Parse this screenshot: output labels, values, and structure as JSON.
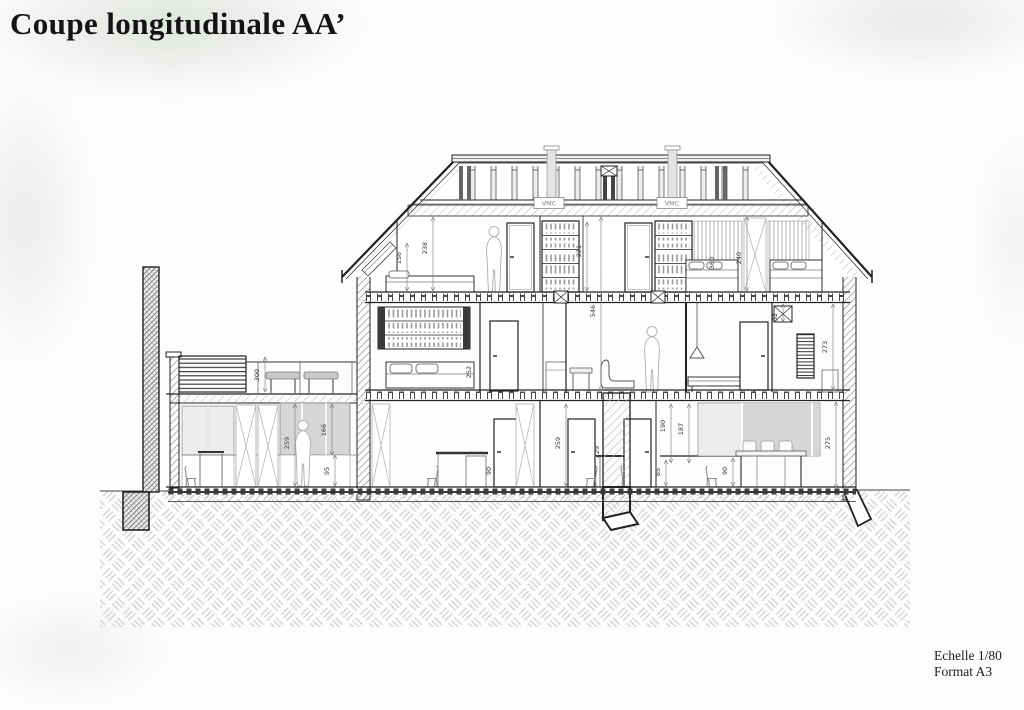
{
  "title": "Coupe longitudinale AA’",
  "footer": {
    "scale": "Echelle 1/80",
    "format": "Format A3"
  },
  "colors": {
    "ink": "#222222",
    "wall_hatch": "#8a8a8a",
    "ground_hatch": "#d2d2d2",
    "glazing_light": "#ececec",
    "glazing_dark": "#d6d6d6"
  },
  "drawing": {
    "vmc_labels": [
      {
        "text": "VMC",
        "x": 549,
        "y": 203
      },
      {
        "text": "VMC",
        "x": 672,
        "y": 203
      }
    ],
    "dimension_labels": [
      {
        "text": "156",
        "x": 401,
        "y": 258,
        "leader": {
          "x": 407,
          "y1": 243,
          "y2": 291
        }
      },
      {
        "text": "238",
        "x": 427,
        "y": 248,
        "leader": {
          "x": 433,
          "y1": 217,
          "y2": 291
        }
      },
      {
        "text": "221",
        "x": 581,
        "y": 251,
        "leader": {
          "x": 587,
          "y1": 222,
          "y2": 291
        }
      },
      {
        "text": "546",
        "x": 595,
        "y": 311,
        "leader": {
          "x": 601,
          "y1": 217,
          "y2": 391
        }
      },
      {
        "text": "360",
        "x": 714,
        "y": 263
      },
      {
        "text": "240",
        "x": 741,
        "y": 258,
        "leader": {
          "x": 747,
          "y1": 217,
          "y2": 291
        }
      },
      {
        "text": "300",
        "x": 259,
        "y": 375,
        "leader": {
          "x": 265,
          "y1": 357,
          "y2": 392
        }
      },
      {
        "text": "252",
        "x": 471,
        "y": 372
      },
      {
        "text": "52",
        "x": 777,
        "y": 317,
        "leader": {
          "x": 783,
          "y1": 304,
          "y2": 322
        }
      },
      {
        "text": "273",
        "x": 827,
        "y": 347,
        "leader": {
          "x": 833,
          "y1": 304,
          "y2": 390
        }
      },
      {
        "text": "259",
        "x": 289,
        "y": 443,
        "leader": {
          "x": 295,
          "y1": 404,
          "y2": 486
        }
      },
      {
        "text": "166",
        "x": 326,
        "y": 430,
        "leader": {
          "x": 332,
          "y1": 404,
          "y2": 455
        }
      },
      {
        "text": "95",
        "x": 329,
        "y": 471,
        "leader": {
          "x": 335,
          "y1": 455,
          "y2": 486
        }
      },
      {
        "text": "90",
        "x": 491,
        "y": 471
      },
      {
        "text": "259",
        "x": 560,
        "y": 443,
        "leader": {
          "x": 566,
          "y1": 404,
          "y2": 486
        }
      },
      {
        "text": "229",
        "x": 599,
        "y": 452
      },
      {
        "text": "190",
        "x": 665,
        "y": 426,
        "leader": {
          "x": 671,
          "y1": 404,
          "y2": 463
        }
      },
      {
        "text": "85",
        "x": 660,
        "y": 472,
        "leader": {
          "x": 666,
          "y1": 460,
          "y2": 486
        }
      },
      {
        "text": "187",
        "x": 683,
        "y": 429,
        "leader": {
          "x": 689,
          "y1": 404,
          "y2": 463
        }
      },
      {
        "text": "90",
        "x": 727,
        "y": 471,
        "leader": {
          "x": 733,
          "y1": 458,
          "y2": 486
        }
      },
      {
        "text": "275",
        "x": 830,
        "y": 443,
        "leader": {
          "x": 836,
          "y1": 402,
          "y2": 488
        }
      }
    ]
  }
}
